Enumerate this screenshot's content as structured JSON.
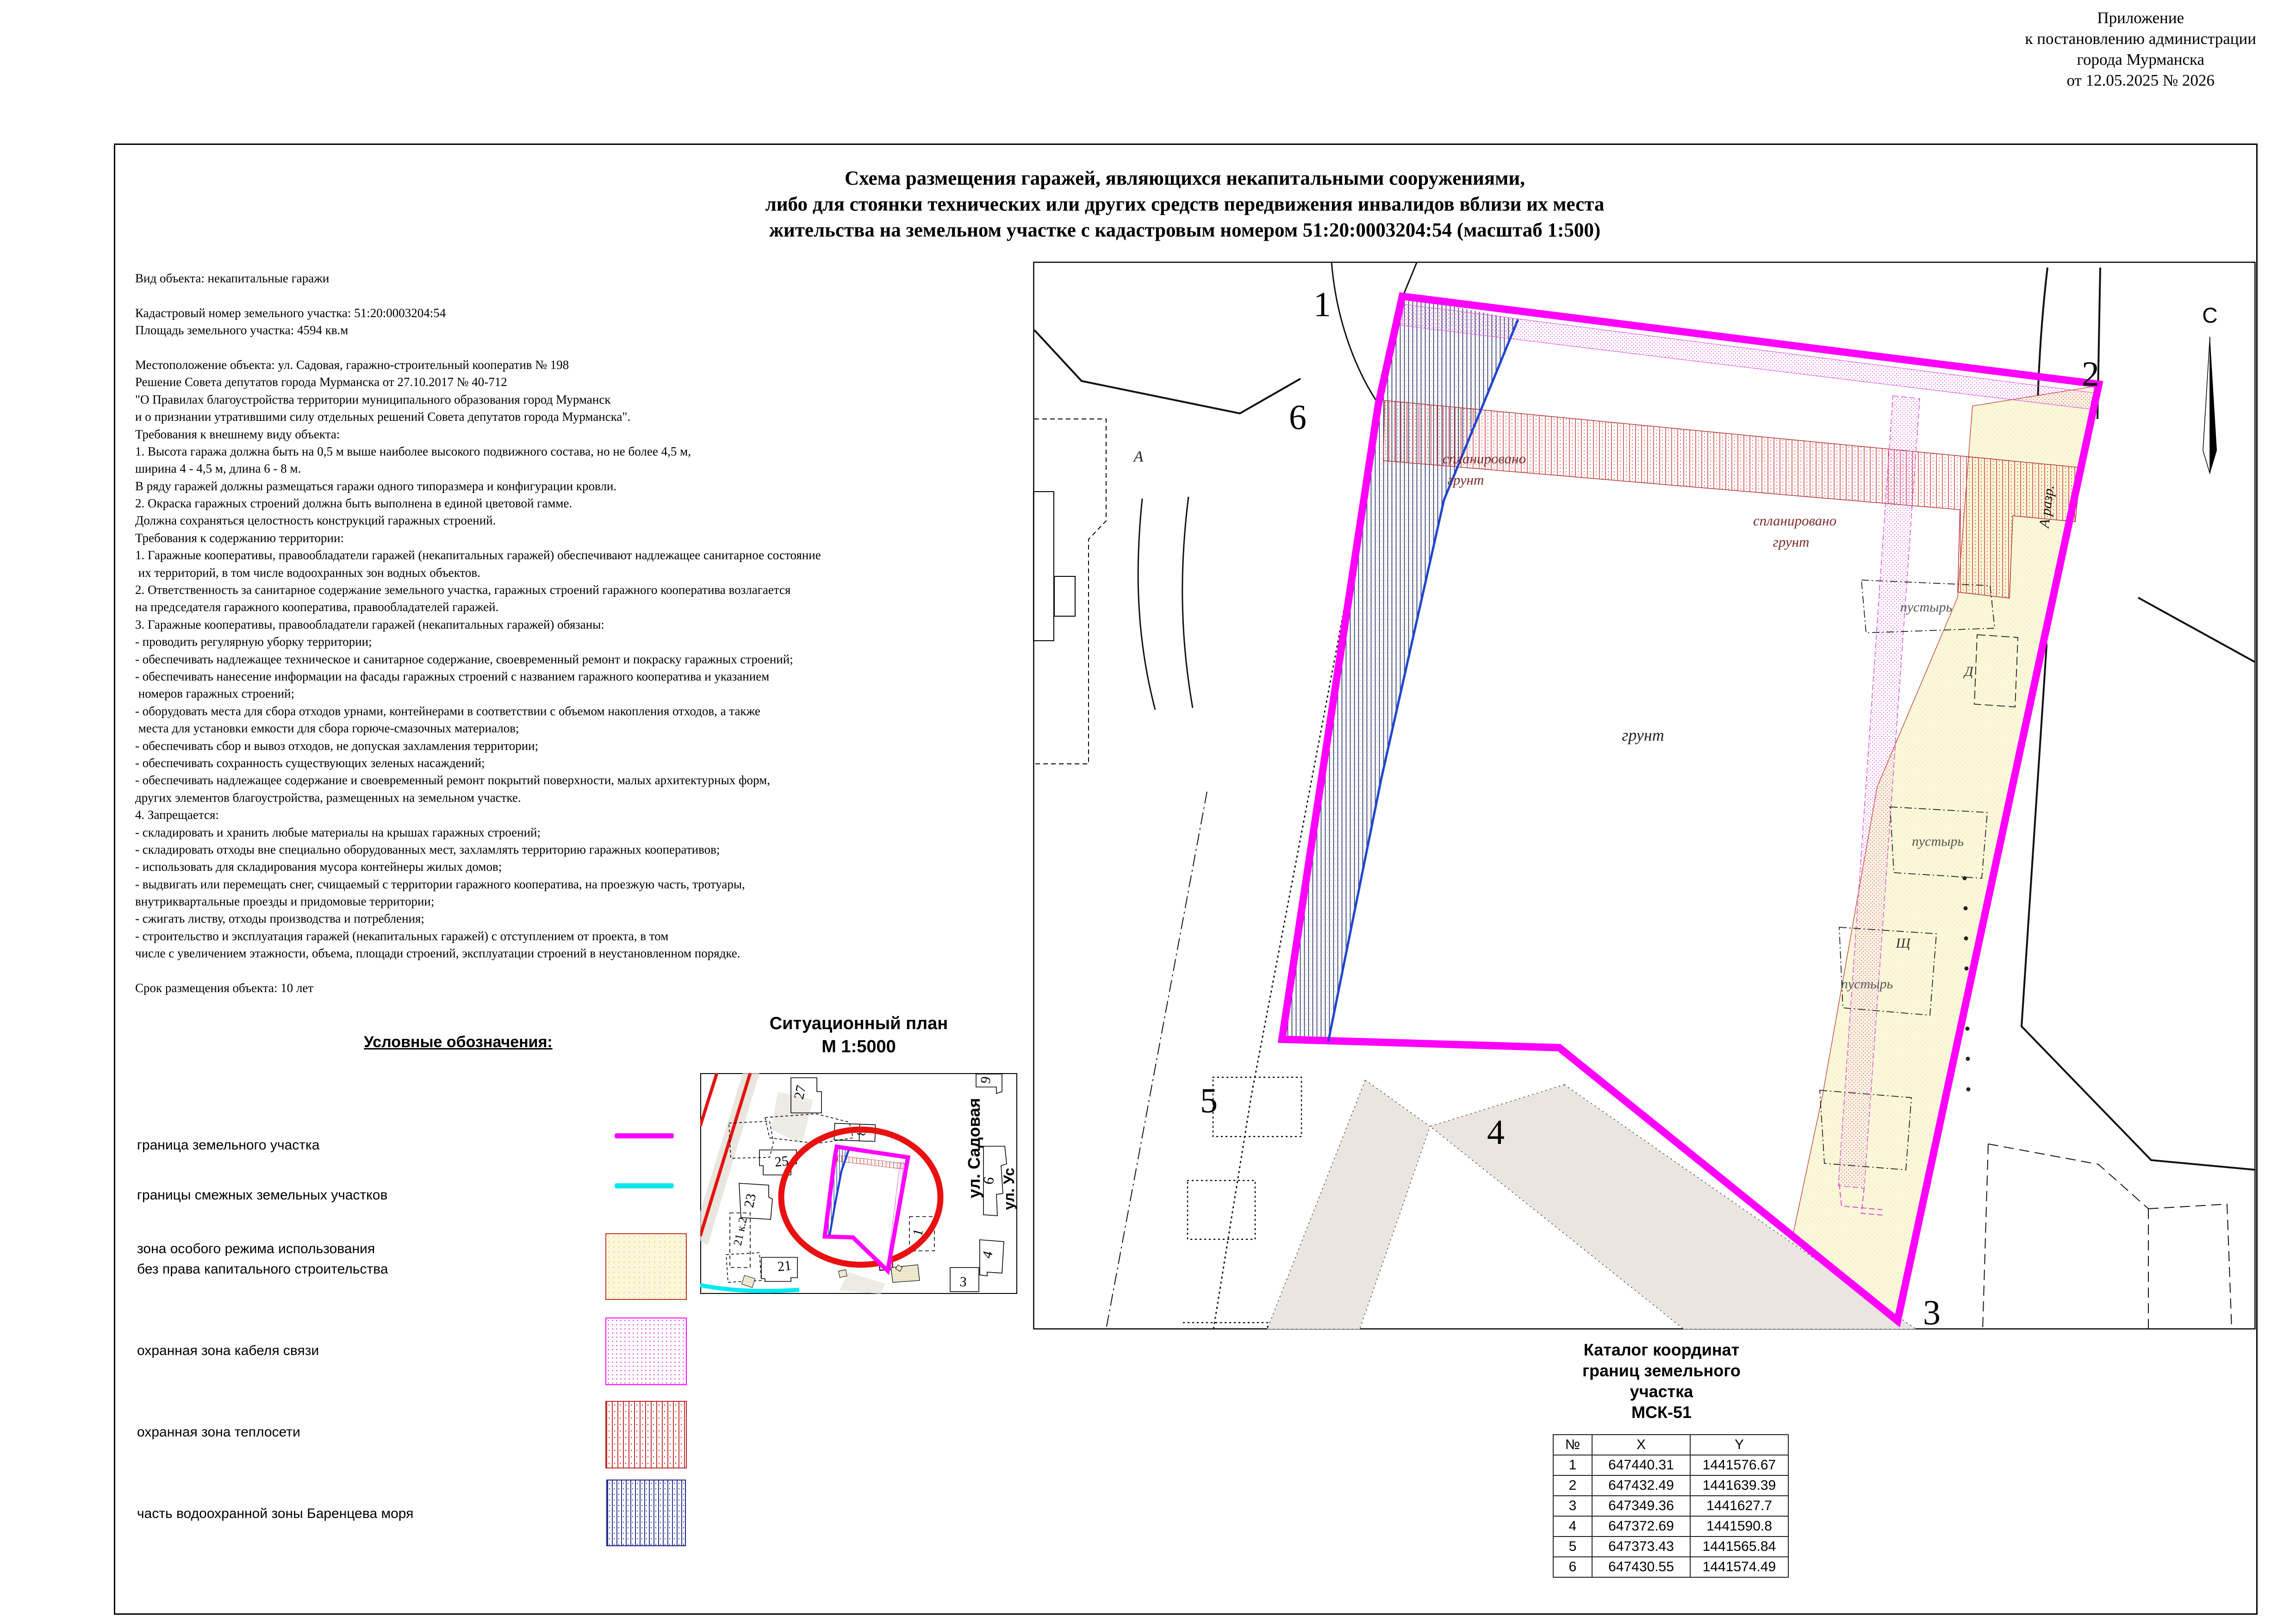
{
  "colors": {
    "boundary": "#FF00FF",
    "adjacent_boundary": "#00E8F0",
    "special_zone_fill": "#FBF8D9",
    "heat_zone": "#C93232",
    "water_zone": "#2b3990",
    "highlight_circle": "#E81010",
    "water_line": "#1f46cf"
  },
  "annex": {
    "lines": [
      "Приложение",
      "к постановлению администрации",
      "города Мурманска",
      "от 12.05.2025 № 2026"
    ]
  },
  "title": {
    "lines": [
      "Схема размещения гаражей, являющихся некапитальными сооружениями,",
      "либо для стоянки технических или других средств передвижения инвалидов вблизи их места",
      "жительства на земельном участке с кадастровым номером 51:20:0003204:54 (масштаб 1:500)"
    ]
  },
  "info": {
    "lines": [
      "Вид объекта: некапитальные гаражи",
      "",
      "Кадастровый номер земельного участка: 51:20:0003204:54",
      "Площадь земельного участка: 4594 кв.м",
      "",
      "Местоположение объекта: ул. Садовая, гаражно-строительный кооператив № 198",
      "Решение Совета депутатов города Мурманска от 27.10.2017 № 40-712",
      "\"О Правилах благоустройства территории муниципального образования город Мурманск",
      "и о признании утратившими силу отдельных решений Совета депутатов города Мурманска\".",
      "Требования к внешнему виду объекта:",
      "1. Высота гаража должна быть на 0,5 м выше наиболее высокого подвижного состава, но не более 4,5 м,",
      "ширина 4 - 4,5 м, длина 6 - 8 м.",
      "В ряду гаражей должны размещаться гаражи одного типоразмера и конфигурации кровли.",
      "2. Окраска гаражных строений должна быть выполнена в единой цветовой гамме.",
      "Должна сохраняться целостность конструкций гаражных строений.",
      "Требования к содержанию территории:",
      "1. Гаражные кооперативы, правообладатели гаражей (некапитальных гаражей) обеспечивают надлежащее санитарное состояние",
      " их территорий, в том числе водоохранных зон водных объектов.",
      "2. Ответственность за санитарное содержание земельного участка, гаражных строений гаражного кооператива возлагается",
      "на председателя гаражного кооператива, правообладателей гаражей.",
      "3. Гаражные кооперативы, правообладатели гаражей (некапитальных гаражей) обязаны:",
      "- проводить регулярную уборку территории;",
      "- обеспечивать надлежащее техническое и санитарное содержание, своевременный ремонт и покраску гаражных строений;",
      "- обеспечивать нанесение информации на фасады гаражных строений с названием гаражного кооператива и указанием",
      " номеров гаражных строений;",
      "- оборудовать места для сбора отходов урнами, контейнерами в соответствии с объемом накопления отходов, а также",
      " места для установки емкости для сбора горюче-смазочных материалов;",
      "- обеспечивать сбор и вывоз отходов, не допуская захламления территории;",
      "- обеспечивать сохранность существующих зеленых насаждений;",
      "- обеспечивать надлежащее содержание и своевременный ремонт покрытий поверхности, малых архитектурных форм,",
      "других элементов благоустройства, размещенных на земельном участке.",
      "4. Запрещается:",
      "- складировать и хранить любые материалы на крышах гаражных строений;",
      "- складировать отходы вне специально оборудованных мест, захламлять территорию гаражных кооперативов;",
      "- использовать для складирования мусора контейнеры жилых домов;",
      "- выдвигать или перемещать снег, счищаемый с территории гаражного кооператива, на проезжую часть, тротуары,",
      "внутриквартальные проезды и придомовые территории;",
      "- сжигать листву, отходы производства и потребления;",
      "- строительство и эксплуатация гаражей (некапитальных гаражей) с отступлением от проекта, в том",
      "числе с увеличением этажности, объема, площади строений, эксплуатации строений в неустановленном порядке.",
      "",
      "Срок размещения объекта: 10 лет"
    ]
  },
  "legend": {
    "heading": "Условные обозначения:",
    "items": [
      {
        "label": "граница земельного участка"
      },
      {
        "label": "границы смежных земельных участков"
      },
      {
        "label": "зона особого режима использования",
        "label2": "без права капитального строительства"
      },
      {
        "label": "охранная зона кабеля связи"
      },
      {
        "label": "охранная зона теплосети"
      },
      {
        "label": "часть водоохранной зоны Баренцева моря"
      }
    ]
  },
  "sitplan": {
    "title": "Ситуационный план",
    "scale": "М 1:5000",
    "street_sadovaya": "ул. Садовая",
    "street_us": "ул. Ус",
    "b27": "27",
    "b25": "25",
    "b23": "23",
    "b21k2": "21 к.2",
    "b21": "21",
    "b8": "8",
    "b9": "9",
    "b6": "6",
    "b1": "1",
    "b3": "3",
    "b4": "4"
  },
  "map": {
    "north": "С",
    "points": {
      "p1": "1",
      "p2": "2",
      "p3": "3",
      "p4": "4",
      "p5": "5",
      "p6": "6"
    },
    "labels": {
      "a": "А",
      "razr": "А  разр.",
      "grunt": "грунт",
      "splan": "спланировано",
      "splan_grunt": "грунт",
      "pustyr": "пустырь",
      "d": "Д",
      "shch": "Щ"
    }
  },
  "table": {
    "title_lines": [
      "Каталог координат",
      "границ земельного",
      "участка",
      "МСК-51"
    ],
    "headers": [
      "№",
      "X",
      "Y"
    ],
    "rows": [
      [
        "1",
        "647440.31",
        "1441576.67"
      ],
      [
        "2",
        "647432.49",
        "1441639.39"
      ],
      [
        "3",
        "647349.36",
        "1441627.7"
      ],
      [
        "4",
        "647372.69",
        "1441590.8"
      ],
      [
        "5",
        "647373.43",
        "1441565.84"
      ],
      [
        "6",
        "647430.55",
        "1441574.49"
      ]
    ]
  }
}
